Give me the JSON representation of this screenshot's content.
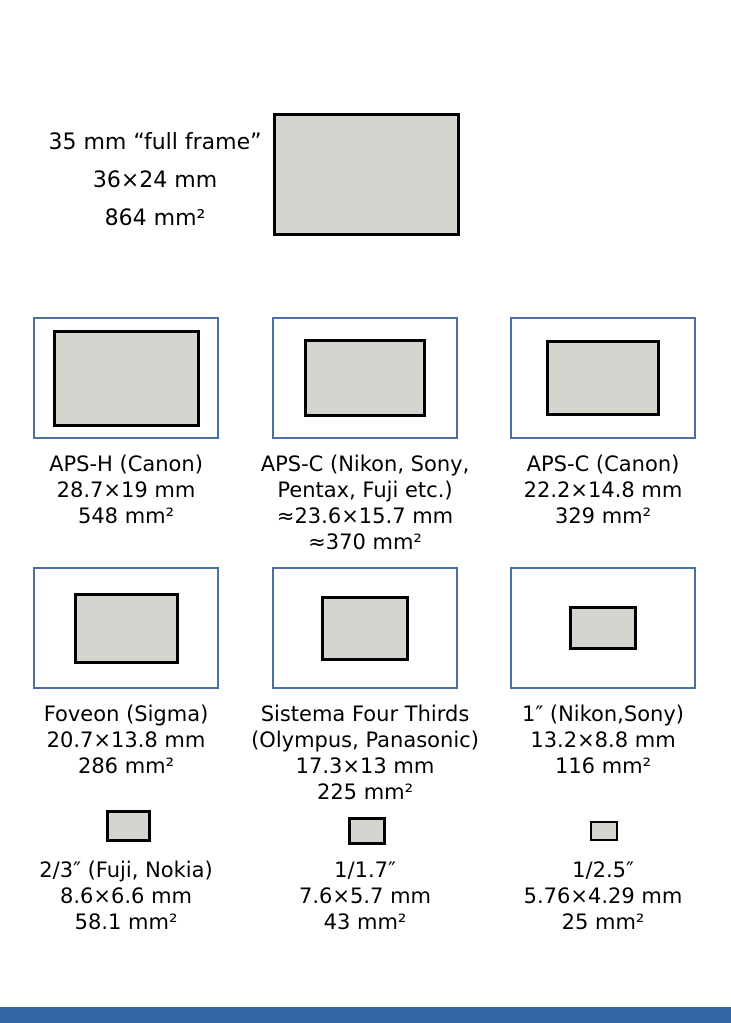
{
  "colors": {
    "background": "#ffffff",
    "sensor_fill": "#d3d6ce",
    "sensor_border": "#000000",
    "cell_border": "#4a6fa5",
    "footer_bar": "#3465a4"
  },
  "full_frame": {
    "lines": [
      "35 mm “full frame”",
      "36×24 mm",
      "864 mm²"
    ]
  },
  "row2": [
    {
      "lines": [
        "APS-H (Canon)",
        "28.7×19 mm",
        "548 mm²"
      ]
    },
    {
      "lines": [
        "APS-C (Nikon, Sony,",
        "Pentax, Fuji etc.)",
        "≈23.6×15.7 mm",
        "≈370 mm²"
      ]
    },
    {
      "lines": [
        "APS-C (Canon)",
        "22.2×14.8 mm",
        "329 mm²"
      ]
    }
  ],
  "row3": [
    {
      "lines": [
        "Foveon (Sigma)",
        "20.7×13.8 mm",
        "286 mm²"
      ]
    },
    {
      "lines": [
        "Sistema Four Thirds",
        "(Olympus, Panasonic)",
        "17.3×13 mm",
        "225 mm²"
      ]
    },
    {
      "lines": [
        "1″ (Nikon,Sony)",
        "13.2×8.8 mm",
        "116 mm²"
      ]
    }
  ],
  "row4": [
    {
      "lines": [
        "2/3″ (Fuji, Nokia)",
        "8.6×6.6 mm",
        "58.1 mm²"
      ]
    },
    {
      "lines": [
        "1/1.7″",
        "7.6×5.7 mm",
        "43 mm²"
      ]
    },
    {
      "lines": [
        "1/2.5″",
        "5.76×4.29 mm",
        "25 mm²"
      ]
    }
  ]
}
